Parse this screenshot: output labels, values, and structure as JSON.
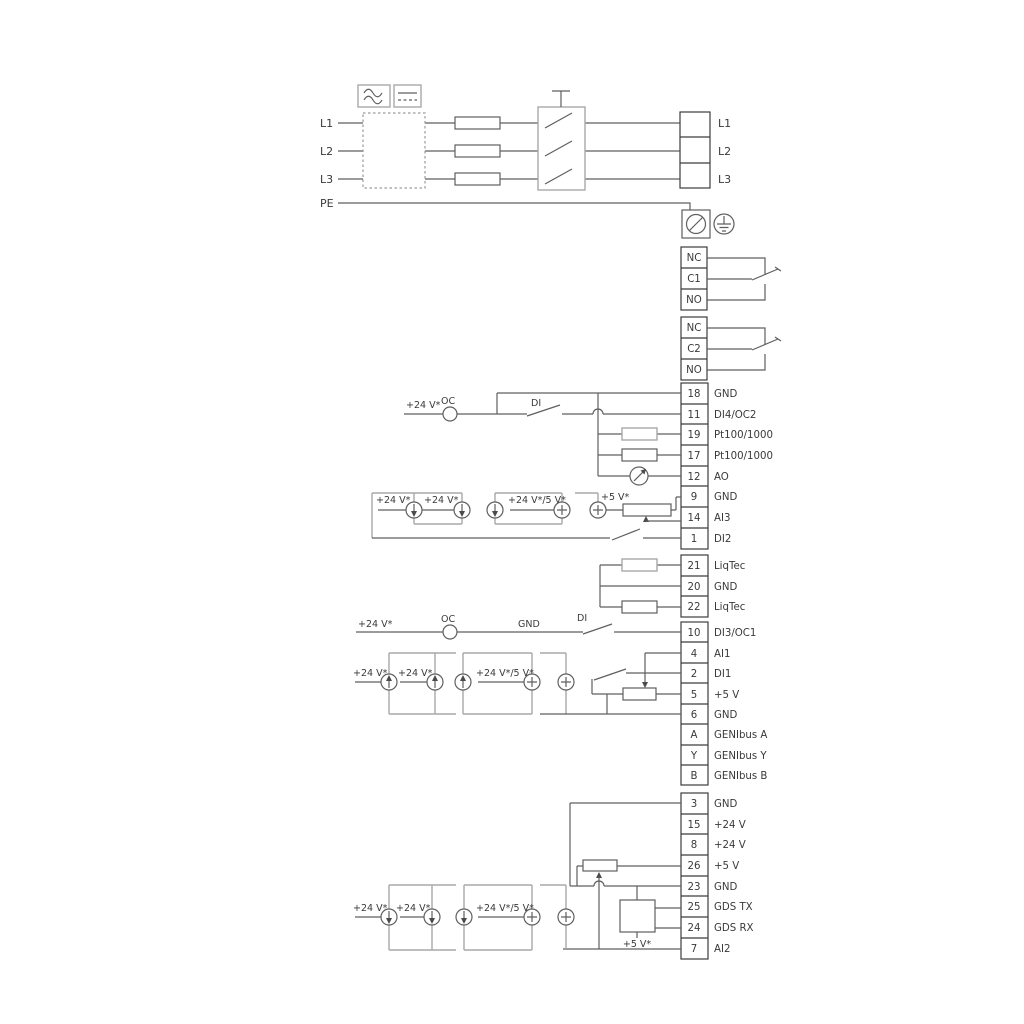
{
  "power": {
    "inputs": [
      "L1",
      "L2",
      "L3",
      "PE"
    ],
    "outputs": [
      "L1",
      "L2",
      "L3"
    ]
  },
  "relay1": {
    "rows": [
      "NC",
      "C1",
      "NO"
    ]
  },
  "relay2": {
    "rows": [
      "NC",
      "C2",
      "NO"
    ]
  },
  "stripA": {
    "rows": [
      {
        "n": "18",
        "l": "GND"
      },
      {
        "n": "11",
        "l": "DI4/OC2"
      },
      {
        "n": "19",
        "l": "Pt100/1000"
      },
      {
        "n": "17",
        "l": "Pt100/1000"
      },
      {
        "n": "12",
        "l": "AO"
      },
      {
        "n": "9",
        "l": "GND"
      },
      {
        "n": "14",
        "l": "AI3"
      },
      {
        "n": "1",
        "l": "DI2"
      }
    ]
  },
  "stripB": {
    "rows": [
      {
        "n": "21",
        "l": "LiqTec"
      },
      {
        "n": "20",
        "l": "GND"
      },
      {
        "n": "22",
        "l": "LiqTec"
      }
    ]
  },
  "stripC": {
    "rows": [
      {
        "n": "10",
        "l": "DI3/OC1"
      },
      {
        "n": "4",
        "l": "AI1"
      },
      {
        "n": "2",
        "l": "DI1"
      },
      {
        "n": "5",
        "l": "+5 V"
      },
      {
        "n": "6",
        "l": "GND"
      },
      {
        "n": "A",
        "l": "GENIbus A"
      },
      {
        "n": "Y",
        "l": "GENIbus Y"
      },
      {
        "n": "B",
        "l": "GENIbus B"
      }
    ]
  },
  "stripD": {
    "rows": [
      {
        "n": "3",
        "l": "GND"
      },
      {
        "n": "15",
        "l": "+24 V"
      },
      {
        "n": "8",
        "l": "+24 V"
      },
      {
        "n": "26",
        "l": "+5 V"
      },
      {
        "n": "23",
        "l": "GND"
      },
      {
        "n": "25",
        "l": "GDS TX"
      },
      {
        "n": "24",
        "l": "GDS RX"
      },
      {
        "n": "7",
        "l": "AI2"
      }
    ]
  },
  "labels": {
    "plus24": "+24 V*",
    "plus24or5": "+24 V*/5 V*",
    "plus5star": "+5 V*",
    "oc": "OC",
    "di": "DI",
    "gnd": "GND"
  }
}
